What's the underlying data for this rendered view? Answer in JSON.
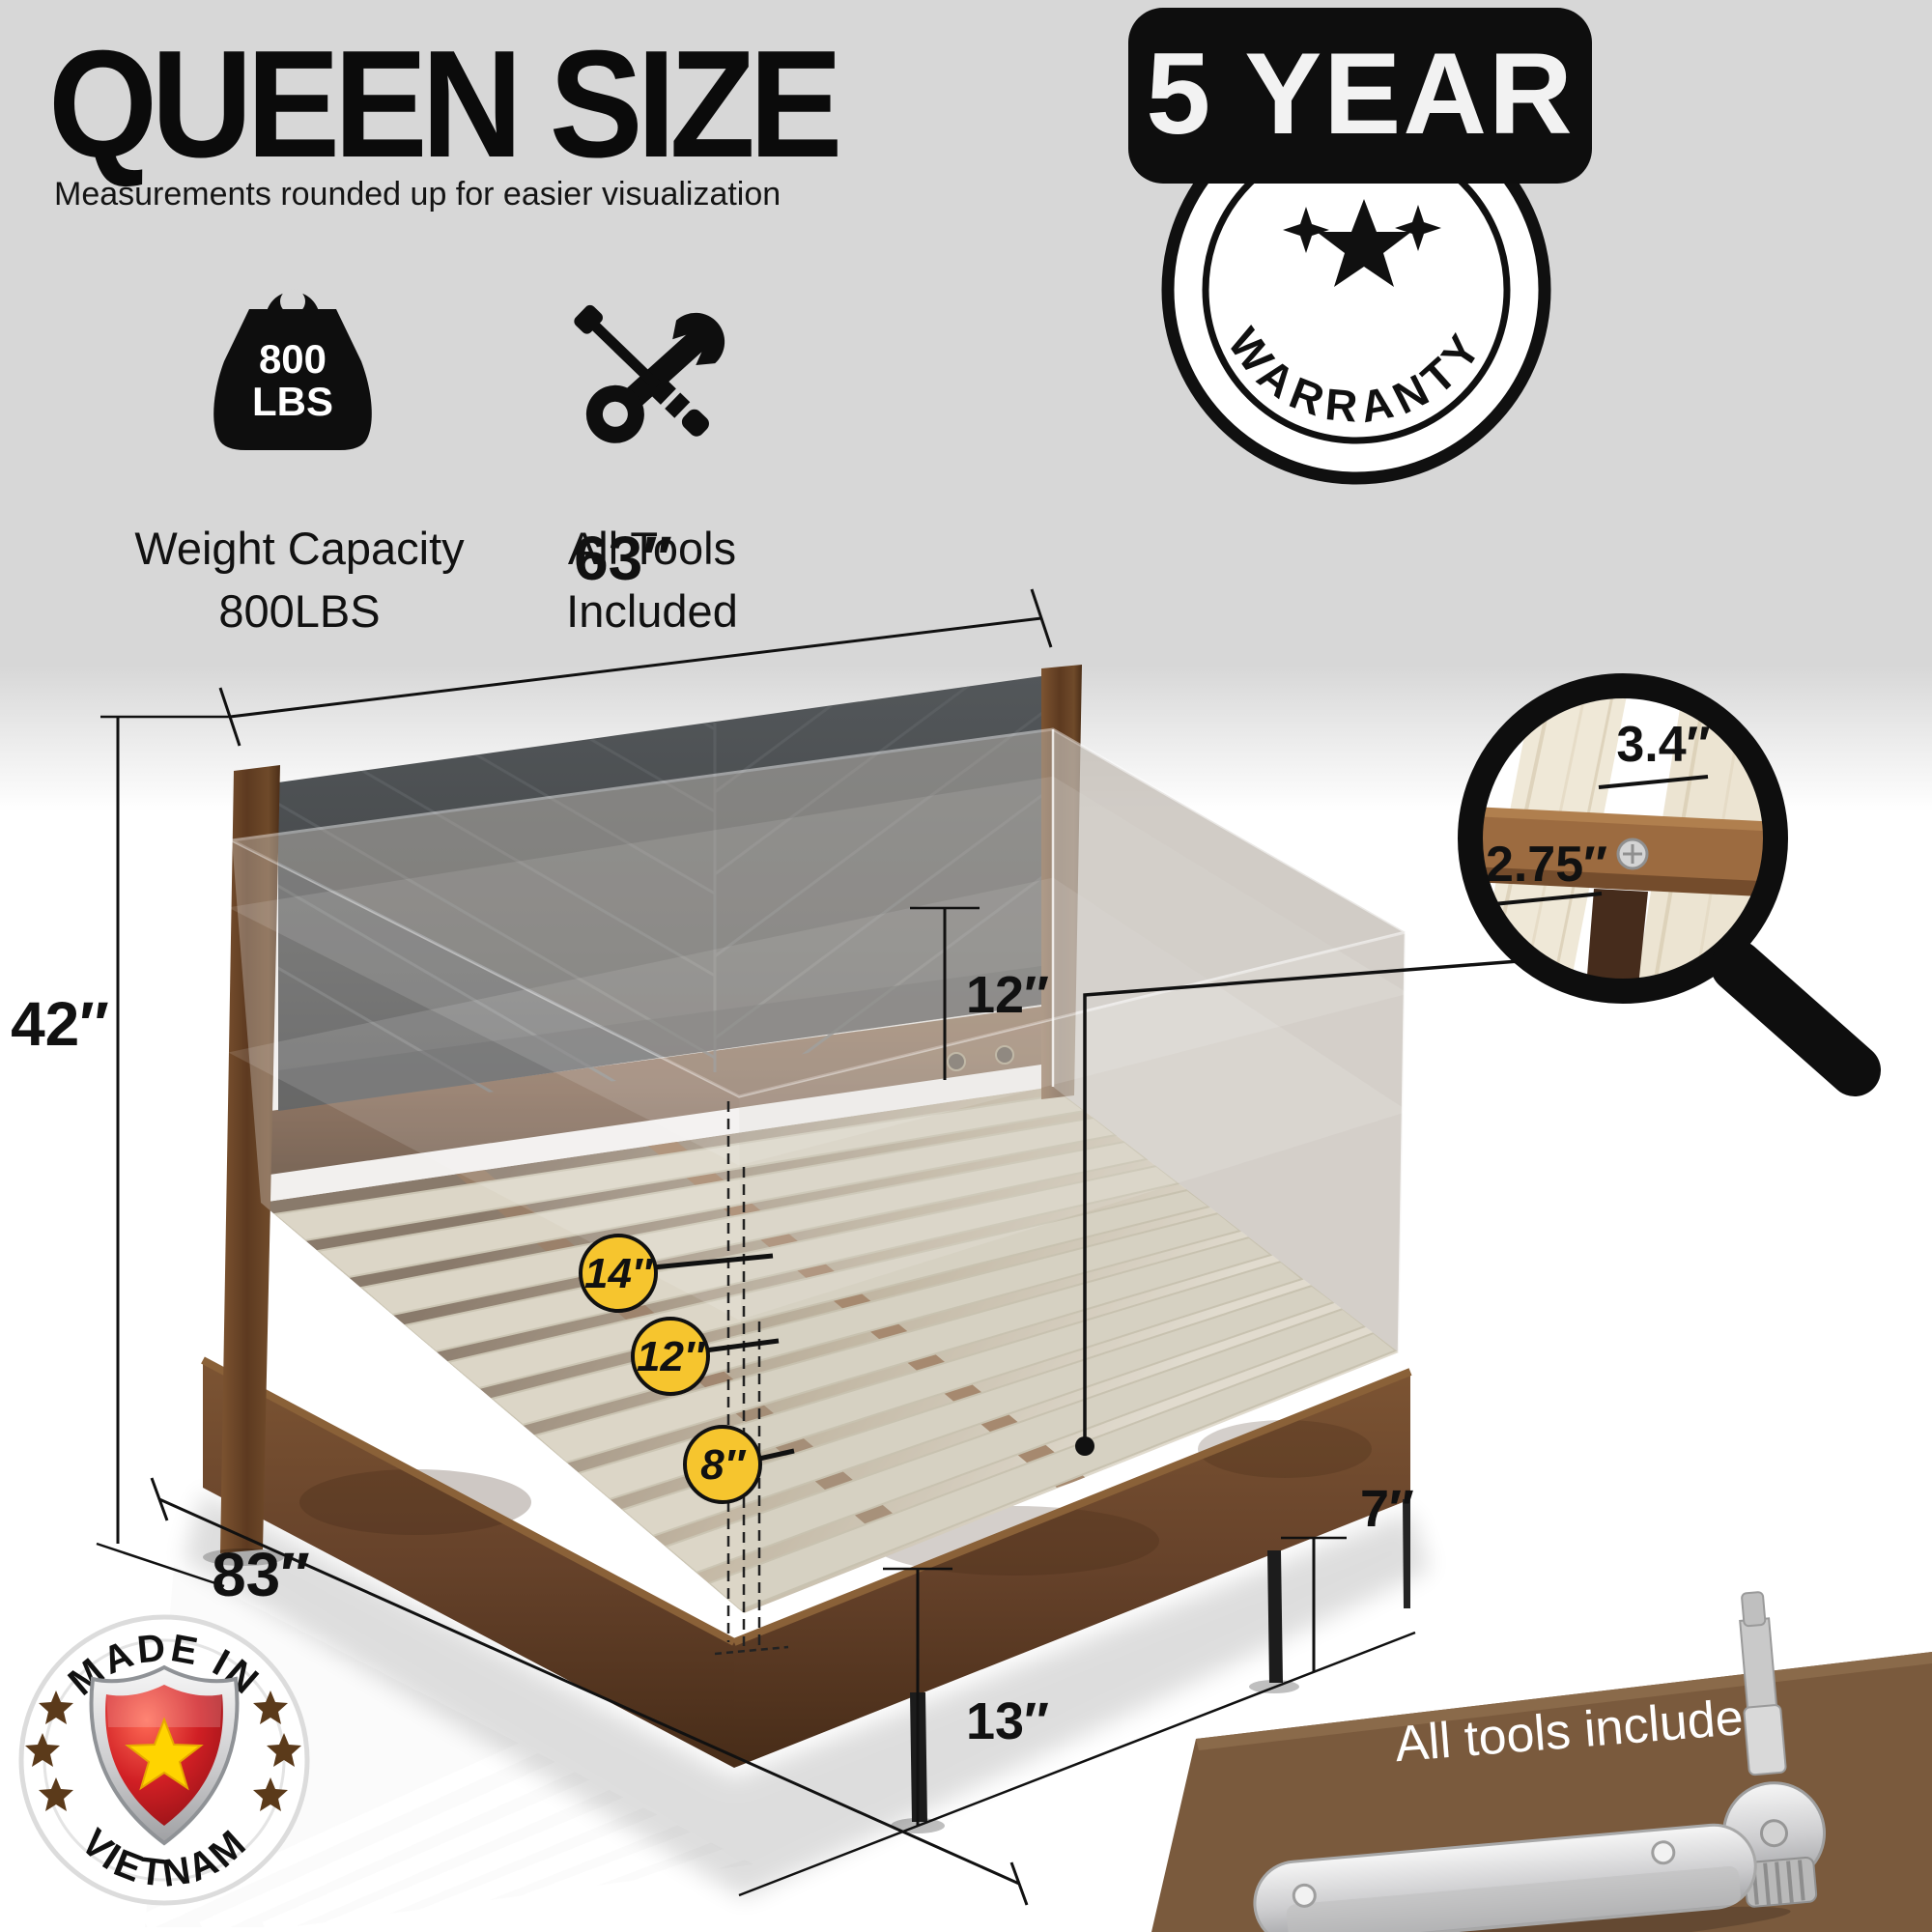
{
  "header": {
    "title": "QUEEN SIZE",
    "subtitle": "Measurements rounded up for easier visualization"
  },
  "features": {
    "weight": {
      "icon": "kettlebell-icon",
      "icon_line1": "800",
      "icon_line2": "LBS",
      "line1": "Weight Capacity",
      "line2": "800LBS"
    },
    "tools": {
      "icon": "crossed-tools-icon",
      "line1": "All Tools",
      "line2": "Included"
    }
  },
  "warranty": {
    "banner": "5 YEAR",
    "stamp": "WARRANTY"
  },
  "bed": {
    "dim_width": "63″",
    "dim_height": "42″",
    "dim_headboard_clearance": "12″",
    "dim_length": "83″",
    "dim_frame_height": "13″",
    "dim_under_clearance": "7″",
    "mattress_heights": [
      "14″",
      "12″",
      "8″"
    ],
    "slat_gap": "3.4″",
    "slat_width": "2.75″"
  },
  "origin": {
    "line1": "MADE IN",
    "line2": "VIETNAM"
  },
  "tools_banner": {
    "label": "All tools included"
  },
  "colors": {
    "accent_yellow": "#F6C52E",
    "badge_black": "#111111",
    "wood_brown": "#6E4A2C",
    "slat_cream": "#DDD8C4",
    "headboard_gray": "#474A4C",
    "banner_brown": "#7A5A3D",
    "flag_red": "#C8102E",
    "star_yellow": "#FFD400"
  }
}
